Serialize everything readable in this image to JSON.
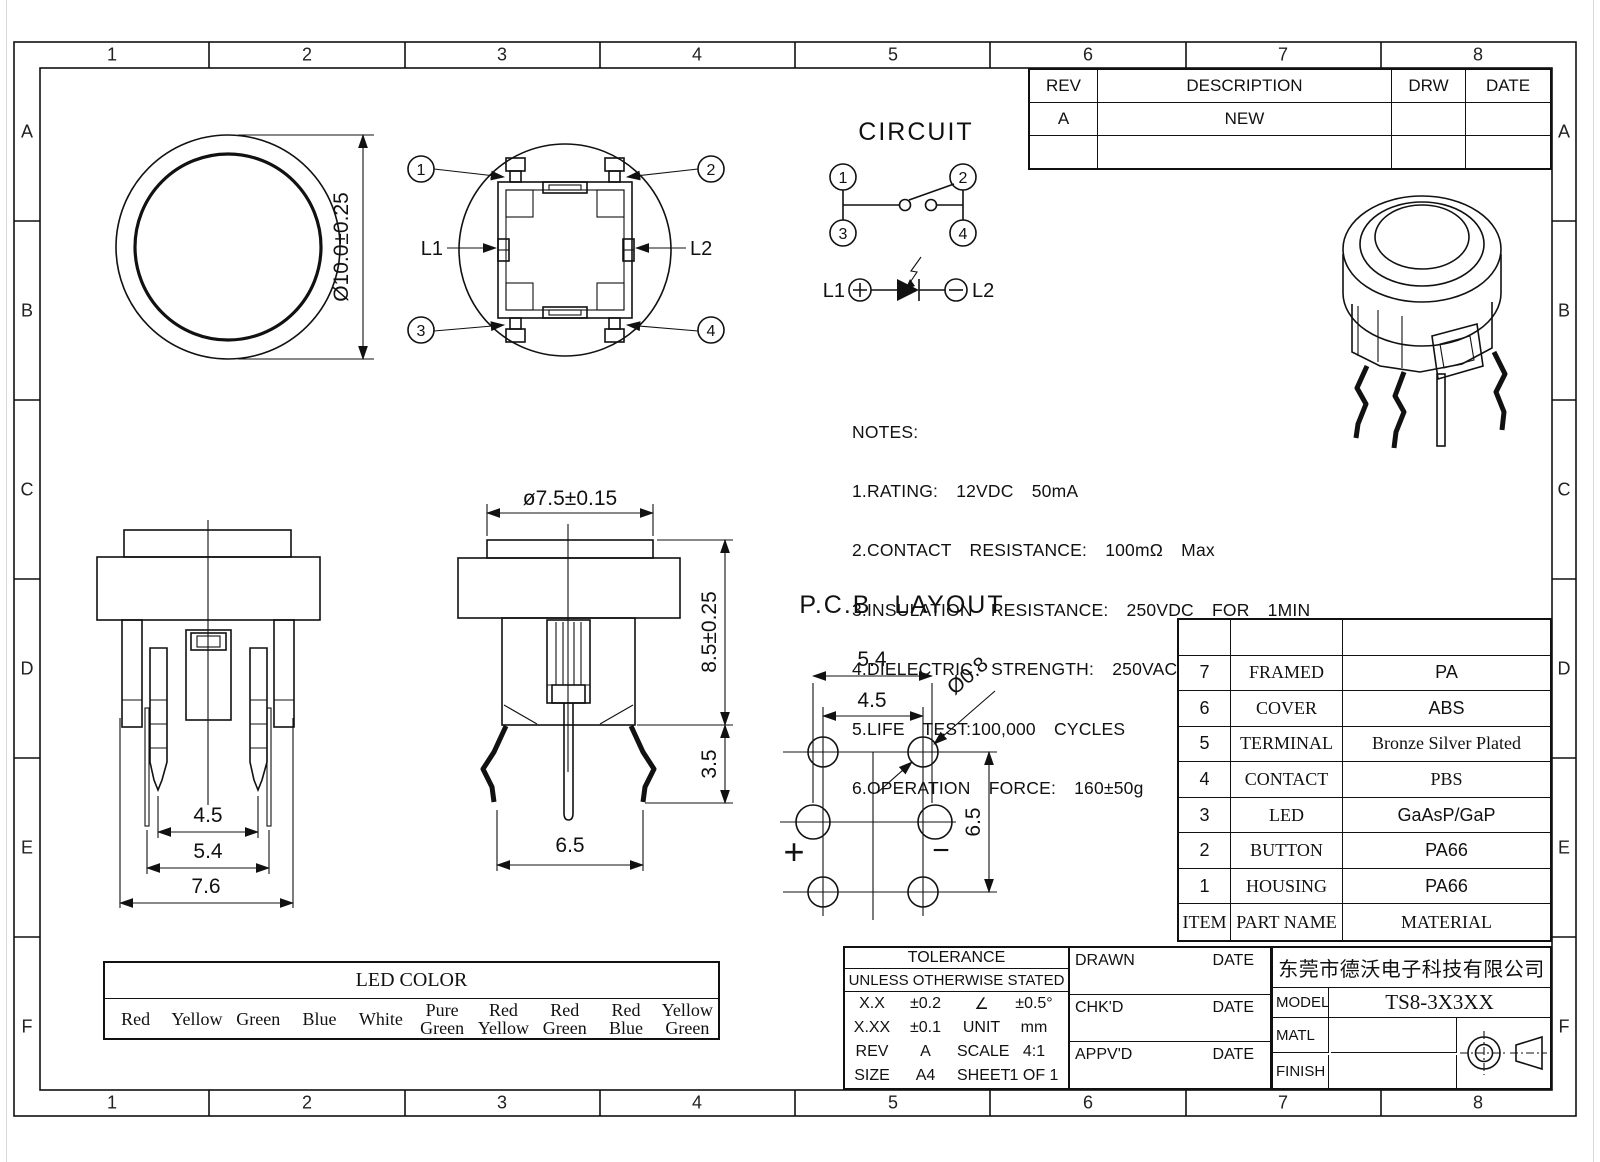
{
  "sheet": {
    "zone_columns": [
      "1",
      "2",
      "3",
      "4",
      "5",
      "6",
      "7",
      "8"
    ],
    "zone_rows": [
      "A",
      "B",
      "C",
      "D",
      "E",
      "F"
    ],
    "line_color": "#111111",
    "bg_color": "#ffffff"
  },
  "revision_table": {
    "col_rev": "REV",
    "col_description": "DESCRIPTION",
    "col_drw": "DRW",
    "col_date": "DATE",
    "rows": [
      {
        "rev": "A",
        "description": "NEW",
        "drw": "",
        "date": ""
      }
    ]
  },
  "top_view": {
    "diameter_dim": "Ø10.0±0.25"
  },
  "bottom_view": {
    "pin1": "1",
    "pin2": "2",
    "pin3": "3",
    "pin4": "4",
    "led_left": "L1",
    "led_right": "L2"
  },
  "circuit": {
    "title": "CIRCUIT",
    "pin1": "1",
    "pin2": "2",
    "pin3": "3",
    "pin4": "4",
    "led_left": "L1",
    "led_right": "L2"
  },
  "front_view": {
    "dim_inner": "4.5",
    "dim_mid": "5.4",
    "dim_outer": "7.6"
  },
  "side_view": {
    "dim_button": "ø7.5±0.15",
    "dim_height": "8.5±0.25",
    "dim_lead": "3.5",
    "dim_body": "6.5"
  },
  "pcb_layout": {
    "title": "P.C.B LAYOUT",
    "dim_outer": "5.4",
    "dim_inner": "4.5",
    "dim_hole": "Ø0.8",
    "dim_vertical": "6.5",
    "polarity_plus": "+",
    "polarity_minus": "−"
  },
  "notes": {
    "title": "NOTES:",
    "lines": [
      "1.RATING:  12VDC  50mA",
      "2.CONTACT  RESISTANCE:  100mΩ  Max",
      "3.INSULATION  RESISTANCE:  250VDC  FOR  1MIN",
      "4.DIELECTRIC  STRENGTH:  250VAC(50/60Hz)  FOR  1MIN",
      "5.LIFE  TEST:100,000  CYCLES",
      "6.OPERATION  FORCE:  160±50g"
    ]
  },
  "parts_table": {
    "header_item": "ITEM",
    "header_part": "PART NAME",
    "header_material": "MATERIAL",
    "rows": [
      {
        "item": "7",
        "part": "FRAMED",
        "material": "PA"
      },
      {
        "item": "6",
        "part": "COVER",
        "material": "ABS"
      },
      {
        "item": "5",
        "part": "TERMINAL",
        "material": "Bronze Silver Plated"
      },
      {
        "item": "4",
        "part": "CONTACT",
        "material": "PBS"
      },
      {
        "item": "3",
        "part": "LED",
        "material": "GaAsP/GaP"
      },
      {
        "item": "2",
        "part": "BUTTON",
        "material": "PA66"
      },
      {
        "item": "1",
        "part": "HOUSING",
        "material": "PA66"
      }
    ]
  },
  "led_color_table": {
    "title": "LED COLOR",
    "colors": [
      "Red",
      "Yellow",
      "Green",
      "Blue",
      "White",
      "Pure Green",
      "Red Yellow",
      "Red Green",
      "Red Blue",
      "Yellow Green"
    ]
  },
  "tolerance_block": {
    "title": "TOLERANCE",
    "subtitle": "UNLESS OTHERWISE STATED",
    "rows": [
      [
        "X.X",
        "±0.2",
        "∠",
        "±0.5°"
      ],
      [
        "X.XX",
        "±0.1",
        "UNIT",
        "mm"
      ],
      [
        "REV",
        "A",
        "SCALE",
        "4:1"
      ],
      [
        "SIZE",
        "A4",
        "SHEET",
        "1 OF 1"
      ]
    ]
  },
  "signoff_block": {
    "drawn_label": "DRAWN",
    "chkd_label": "CHK'D",
    "appvd_label": "APPV'D",
    "date_label": "DATE"
  },
  "title_block": {
    "company": "东莞市德沃电子科技有限公司",
    "model_label": "MODEL",
    "model_value": "TS8-3X3XX",
    "matl_label": "MATL",
    "matl_value": "",
    "finish_label": "FINISH",
    "finish_value": ""
  }
}
